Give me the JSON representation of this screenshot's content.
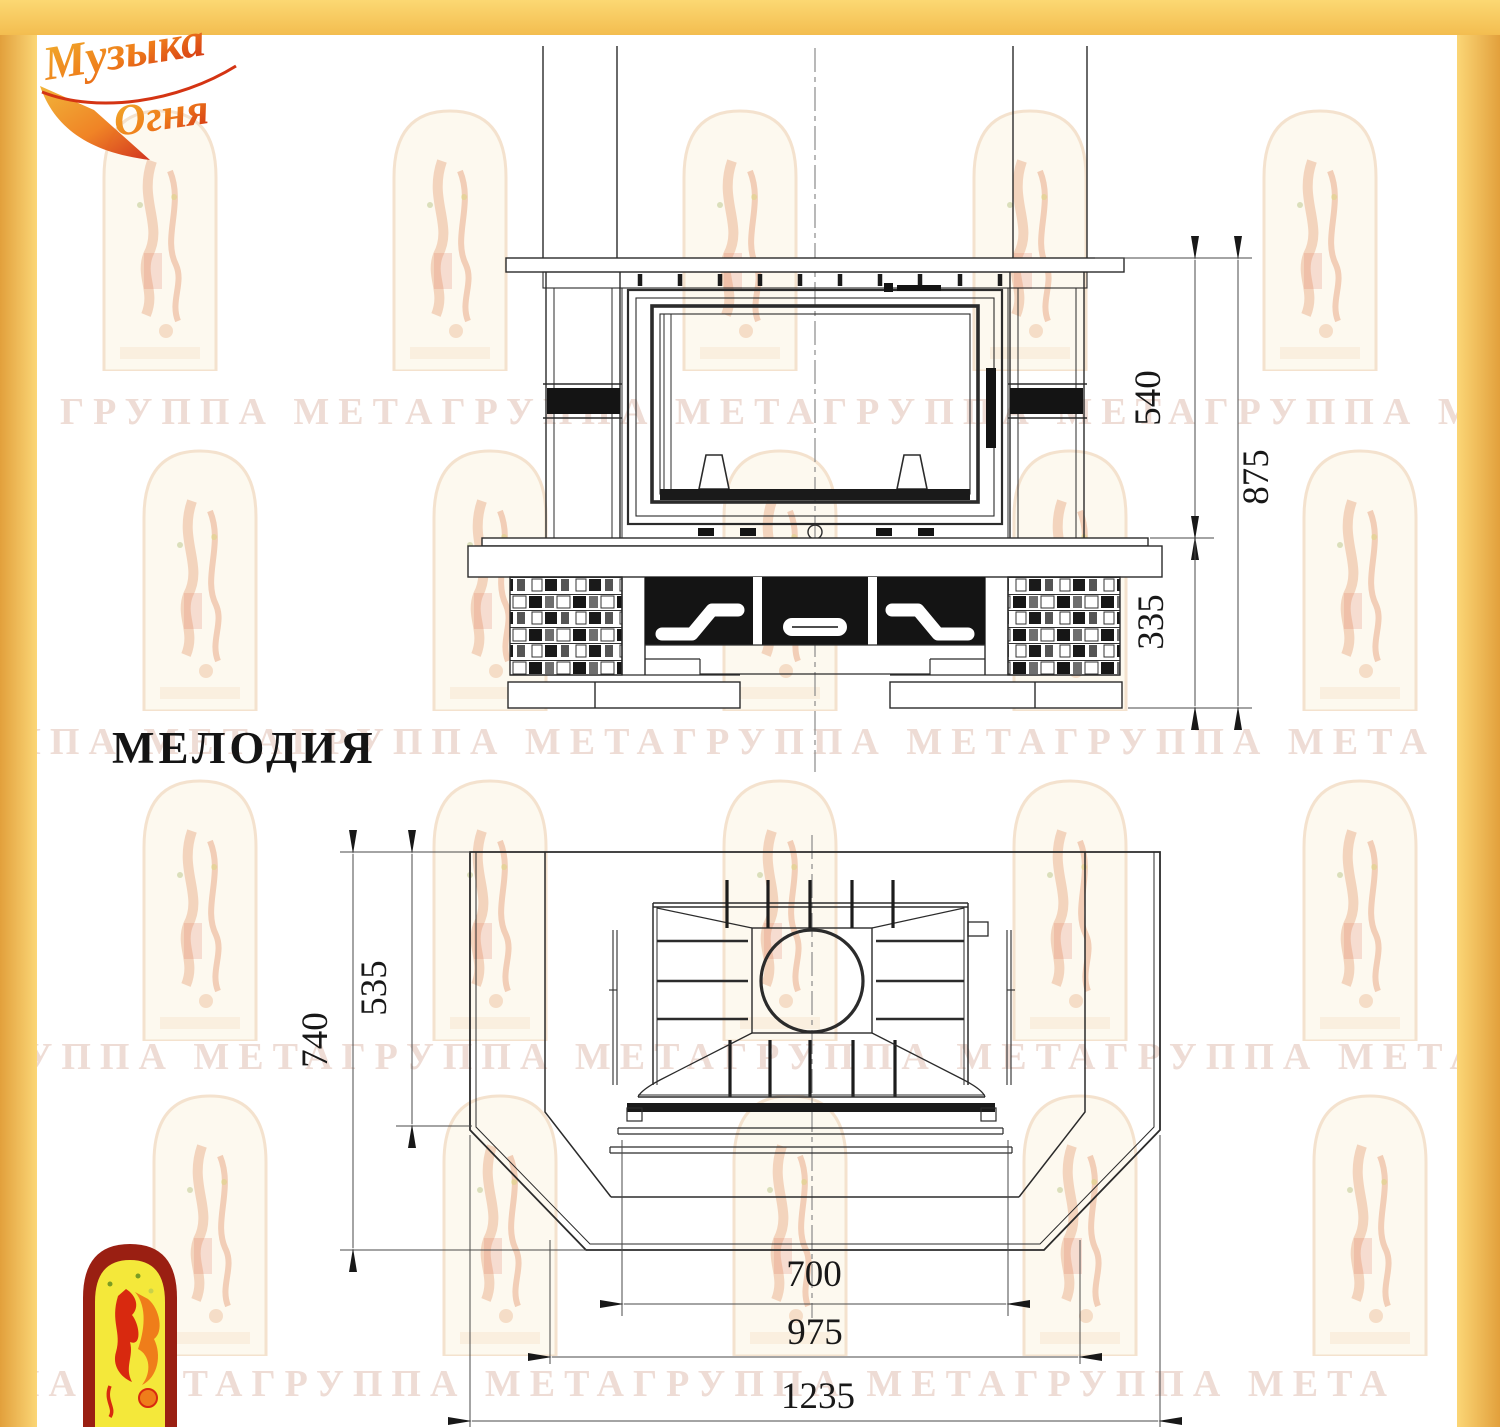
{
  "title": {
    "model_name": "МЕЛОДИЯ"
  },
  "brand": {
    "top_logo_line1": "Музыка",
    "top_logo_line2": "Огня"
  },
  "watermark": {
    "rows": [
      {
        "text": "ГРУППА МЕТАГРУППА МЕТАГРУППА МЕТАГРУППА МЕТА"
      },
      {
        "text": "ГРУППА МЕТАГРУППА МЕТАГРУППА МЕТАГРУППА МЕТА"
      },
      {
        "text": "ГРУППА МЕТАГРУППА МЕТАГРУППА МЕТАГРУППА МЕТА"
      },
      {
        "text": "ГРУППА МЕТАГРУППА МЕТАГРУППА МЕТАГРУППА МЕТА"
      }
    ]
  },
  "front_view": {
    "labels": {
      "height_firebox": "540",
      "height_total": "875",
      "height_base": "335"
    }
  },
  "plan_view": {
    "labels": {
      "depth_total": "740",
      "depth_side": "535",
      "width_firebox": "700",
      "width_middle": "975",
      "width_total": "1235"
    }
  },
  "colors": {
    "accent_yellow": "#f6c95f",
    "line": "#2b2b2b",
    "black_fill": "#141414",
    "logo_red": "#d8290f",
    "logo_orange": "#ef7d1a",
    "logo_yellow_fill": "#f4e83a"
  }
}
